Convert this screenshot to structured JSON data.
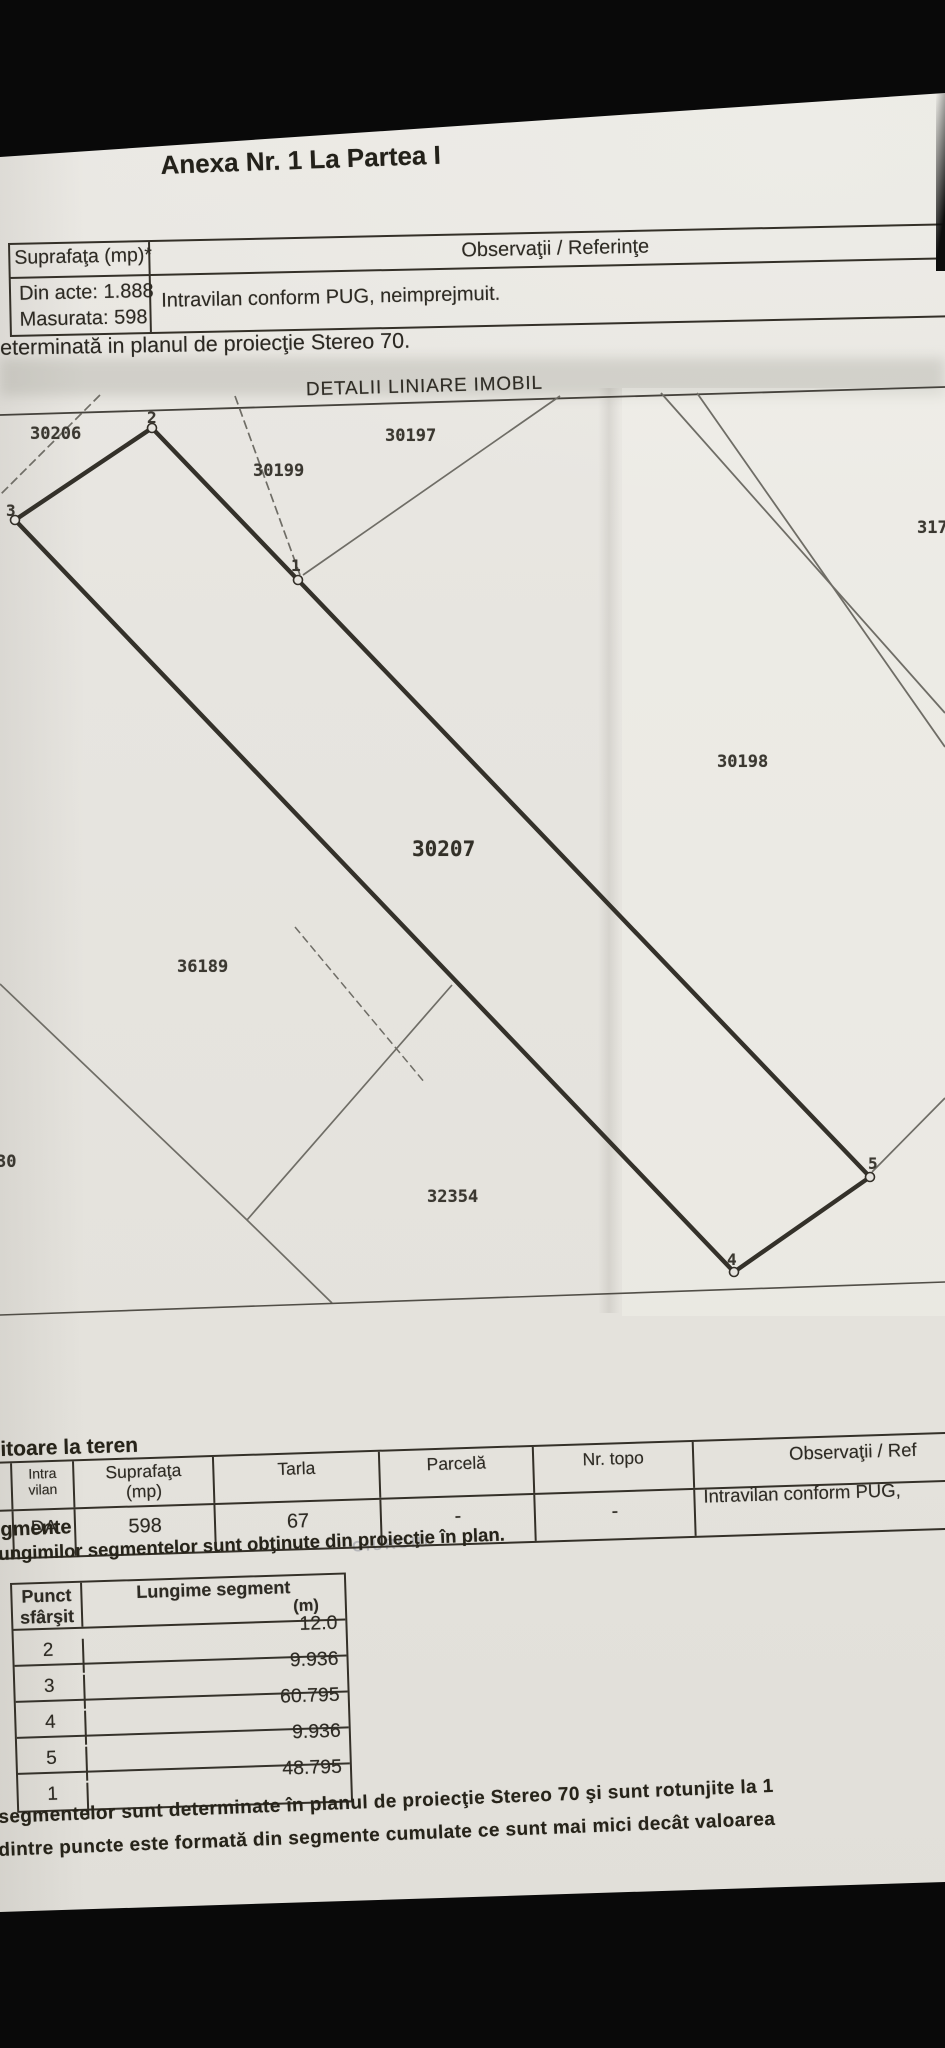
{
  "document": {
    "title": "Anexa Nr. 1 La Partea I",
    "colors": {
      "paper": "#e6e4df",
      "ink": "#2b2922",
      "line": "#343028",
      "background": "#090909"
    }
  },
  "top_table": {
    "surface_header": "Suprafaţa (mp)*",
    "observations_header": "Observaţii / Referinţe",
    "din_acte": "Din acte: 1.888",
    "masurata": "Masurata: 598",
    "observation_value": "Intravilan conform PUG, neimprejmuit.",
    "projection_note": "determinată in planul de proiecţie Stereo 70."
  },
  "plan": {
    "heading": "DETALII LINIARE IMOBIL",
    "labels": [
      "30206",
      "2",
      "30199",
      "30197",
      "3",
      "1",
      "317",
      "30198",
      "30207",
      "36189",
      "30",
      "32354",
      "5",
      "4"
    ]
  },
  "teren_table": {
    "section_title": "itoare la teren",
    "headers": [
      "Intra vilan",
      "Suprafaţa (mp)",
      "Tarla",
      "Parcelă",
      "Nr. topo",
      "Observaţii / Ref"
    ],
    "row": [
      "DA",
      "598",
      "67",
      "-",
      "-",
      "Intravilan conform PUG,"
    ]
  },
  "segments": {
    "heading_fragment": "gmente",
    "note_fragment": "ungimilor segmentelor sunt obţinute din proiecţie în plan.",
    "col_punct": "Punct sfârşit",
    "col_lungime": "Lungime segment",
    "col_lungime_unit": "(m)",
    "rows": [
      {
        "punct": "2",
        "lungime": "12.0"
      },
      {
        "punct": "3",
        "lungime": "9.936"
      },
      {
        "punct": "4",
        "lungime": "60.795"
      },
      {
        "punct": "5",
        "lungime": "9.936"
      },
      {
        "punct": "1",
        "lungime": "48.795"
      }
    ],
    "footnote1": "segmentelor sunt determinate în planul de proiecţie Stereo 70 şi sunt rotunjite la 1",
    "footnote2": "dintre puncte este formată din segmente cumulate ce sunt mai mici decât valoarea"
  },
  "watermark": "GIURGIU"
}
